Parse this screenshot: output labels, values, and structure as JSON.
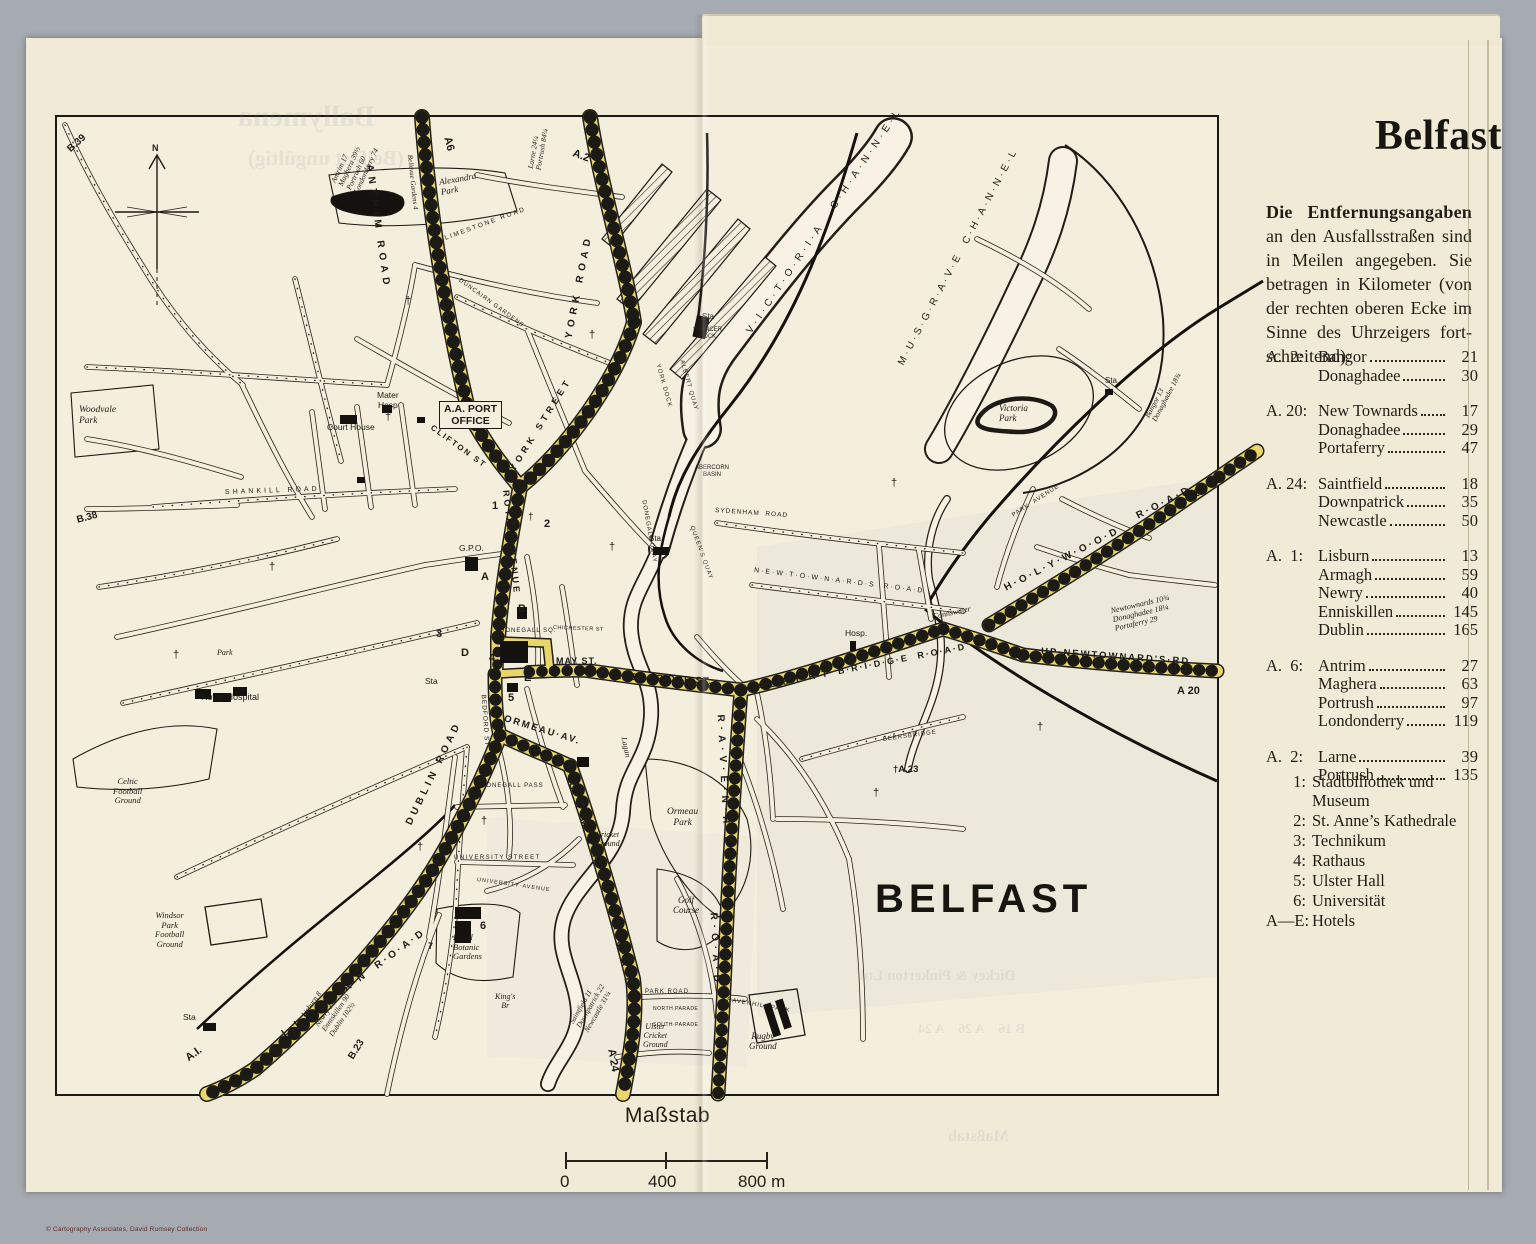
{
  "colors": {
    "paper": "#f1ead6",
    "map_paper": "#f4eedd",
    "road_yellow": "#e9d66b",
    "ink": "#1c1a15",
    "background_grey": "#a6aab1"
  },
  "page": {
    "copyright": "© Cartography Associates, David Rumsey Collection"
  },
  "panel": {
    "title": "Belfast",
    "intro_bold": "Die Entfernungsangaben",
    "intro_rest": " an den Ausfallsstraßen sind in Meilen angegeben.  Sie betragen in Kilometer (von der rechten oberen Ecke im Sinne des Uhrzeigers fort­schreitend):",
    "groups": [
      {
        "route": "A.  2:",
        "rows": [
          [
            "Bangor",
            "21"
          ],
          [
            "Donaghadee",
            "30"
          ]
        ]
      },
      {
        "route": "A. 20:",
        "rows": [
          [
            "New Townards",
            "17"
          ],
          [
            "Donaghadee",
            "29"
          ],
          [
            "Portaferry",
            "47"
          ]
        ]
      },
      {
        "route": "A. 24:",
        "rows": [
          [
            "Saintfield",
            "18"
          ],
          [
            "Downpatrick",
            "35"
          ],
          [
            "Newcastle",
            "50"
          ]
        ]
      },
      {
        "route": "A.  1:",
        "rows": [
          [
            "Lisburn",
            "13"
          ],
          [
            "Armagh",
            "59"
          ],
          [
            "Newry",
            "40"
          ],
          [
            "Enniskillen",
            "145"
          ],
          [
            "Dublin",
            "165"
          ]
        ]
      },
      {
        "route": "A.  6:",
        "rows": [
          [
            "Antrim",
            "27"
          ],
          [
            "Maghera",
            "63"
          ],
          [
            "Portrush",
            "97"
          ],
          [
            "Londonderry",
            "119"
          ]
        ]
      },
      {
        "route": "A.  2:",
        "rows": [
          [
            "Larne",
            "39"
          ],
          [
            "Portrush",
            "135"
          ]
        ]
      }
    ],
    "legend": [
      [
        "1:",
        "Stadtbiliothek und Museum"
      ],
      [
        "2:",
        "St. Anne’s Kathedrale"
      ],
      [
        "3:",
        "Technikum"
      ],
      [
        "4:",
        "Rathaus"
      ],
      [
        "5:",
        "Ulster Hall"
      ],
      [
        "6:",
        "Universität"
      ],
      [
        "A—E:",
        "Hotels"
      ]
    ]
  },
  "scale": {
    "title": "Maßstab",
    "t0": "0",
    "t400": "400",
    "t800": "800 m"
  },
  "map": {
    "city_label": "BELFAST",
    "labels": [
      {
        "t": "A6",
        "x": 390,
        "y": 14,
        "r": 75,
        "s": 11,
        "w": 700
      },
      {
        "t": "ANTRIM ROAD",
        "x": 312,
        "y": 42,
        "r": 82,
        "s": 10,
        "ls": 5,
        "w": 700
      },
      {
        "t": "Bellevue Gardens 4",
        "x": 352,
        "y": 34,
        "r": 84,
        "s": 7,
        "i": 1,
        "c": "ser"
      },
      {
        "t": "Antrim 17\nMaghera 39½\nPortrush 60\nLondonderry 74",
        "x": 288,
        "y": 54,
        "r": -65,
        "s": 7.5,
        "i": 1,
        "c": "ser"
      },
      {
        "t": "A.2",
        "x": 516,
        "y": 30,
        "r": 20,
        "s": 11,
        "w": 700
      },
      {
        "t": "Larne 24¼\nPortrush 84¼",
        "x": 478,
        "y": 44,
        "r": -80,
        "s": 7.5,
        "i": 1,
        "c": "ser"
      },
      {
        "t": "YORK ROAD",
        "x": 512,
        "y": 216,
        "r": -79,
        "s": 10,
        "ls": 5,
        "w": 700
      },
      {
        "t": "Alexandra\nPark",
        "x": 383,
        "y": 60,
        "r": -10,
        "s": 9,
        "i": 1,
        "c": "ser"
      },
      {
        "t": "LIMESTONE ROAD",
        "x": 388,
        "y": 118,
        "r": -20,
        "s": 6.5,
        "ls": 2
      },
      {
        "t": "DUNCAIRN GARDENS",
        "x": 402,
        "y": 160,
        "r": 36,
        "s": 6,
        "ls": 1
      },
      {
        "t": "B.39",
        "x": 12,
        "y": 28,
        "r": -42,
        "s": 10,
        "w": 700
      },
      {
        "t": "N",
        "x": 95,
        "y": 26,
        "s": 9,
        "w": 700
      },
      {
        "t": "Woodvale\nPark",
        "x": 22,
        "y": 288,
        "s": 9.5,
        "i": 1,
        "c": "ser"
      },
      {
        "t": "B.38",
        "x": 20,
        "y": 398,
        "r": -15,
        "s": 10,
        "w": 700
      },
      {
        "t": "SHANKILL ROAD",
        "x": 168,
        "y": 372,
        "r": -2,
        "s": 7,
        "ls": 3
      },
      {
        "t": "Mater\nHosp",
        "x": 320,
        "y": 274,
        "s": 8.5,
        "a": "center"
      },
      {
        "t": "A.A. PORT\nOFFICE",
        "x": 382,
        "y": 284,
        "s": 10.5,
        "w": 700,
        "c": "boxed",
        "a": "center"
      },
      {
        "t": "Court House",
        "x": 270,
        "y": 306,
        "s": 8.5
      },
      {
        "t": "CLIFTON ST",
        "x": 374,
        "y": 306,
        "r": 36,
        "s": 8,
        "ls": 2,
        "w": 700
      },
      {
        "t": "YORK STREET",
        "x": 455,
        "y": 348,
        "r": -58,
        "s": 9,
        "ls": 4,
        "w": 700
      },
      {
        "t": "ROYAL AVENUE",
        "x": 449,
        "y": 368,
        "r": 84,
        "s": 9,
        "ls": 3,
        "w": 700
      },
      {
        "t": "1",
        "x": 435,
        "y": 383,
        "s": 11,
        "w": 700
      },
      {
        "t": "†",
        "x": 471,
        "y": 395,
        "s": 10
      },
      {
        "t": "2",
        "x": 487,
        "y": 401,
        "s": 11,
        "w": 700
      },
      {
        "t": "G.P.O.",
        "x": 402,
        "y": 427,
        "s": 8.5
      },
      {
        "t": "A",
        "x": 424,
        "y": 454,
        "s": 11,
        "w": 700
      },
      {
        "t": "B",
        "x": 461,
        "y": 486,
        "s": 11,
        "w": 700
      },
      {
        "t": "3",
        "x": 379,
        "y": 511,
        "s": 11,
        "w": 700
      },
      {
        "t": "D",
        "x": 404,
        "y": 530,
        "s": 11,
        "w": 700
      },
      {
        "t": "4",
        "x": 432,
        "y": 535,
        "s": 11,
        "w": 700
      },
      {
        "t": "E",
        "x": 467,
        "y": 555,
        "s": 11,
        "w": 700
      },
      {
        "t": "5",
        "x": 451,
        "y": 575,
        "s": 11,
        "w": 700
      },
      {
        "t": "Sta",
        "x": 368,
        "y": 560,
        "s": 8.5
      },
      {
        "t": "DONEGALL SQ.",
        "x": 443,
        "y": 511,
        "s": 6,
        "ls": 1
      },
      {
        "t": "MAY ST.",
        "x": 499,
        "y": 539,
        "s": 9,
        "w": 700,
        "ls": 1
      },
      {
        "t": "EAST·BRIDGE·ST.",
        "x": 558,
        "y": 555,
        "r": 3,
        "s": 9.5,
        "w": 700,
        "ls": 1
      },
      {
        "t": "BEDFORD ST",
        "x": 426,
        "y": 574,
        "r": 86,
        "s": 6.5,
        "ls": 1
      },
      {
        "t": "DUBLIN ROAD",
        "x": 352,
        "y": 702,
        "r": -64,
        "s": 10,
        "ls": 4,
        "w": 700
      },
      {
        "t": "ORMEAU·AV.",
        "x": 447,
        "y": 597,
        "r": 17,
        "s": 9.5,
        "ls": 2,
        "w": 700
      },
      {
        "t": "O·R·M·E·A·U",
        "x": 514,
        "y": 660,
        "r": 72,
        "s": 10,
        "ls": 4,
        "w": 700
      },
      {
        "t": "R·O·A·D",
        "x": 558,
        "y": 800,
        "r": 78,
        "s": 10,
        "ls": 4,
        "w": 700
      },
      {
        "t": "A 24",
        "x": 554,
        "y": 926,
        "r": 80,
        "s": 11,
        "w": 700
      },
      {
        "t": "DONEGALL PASS",
        "x": 424,
        "y": 666,
        "s": 6,
        "ls": 1
      },
      {
        "t": "UNIVERSITY STREET",
        "x": 397,
        "y": 738,
        "s": 6,
        "ls": 1.5
      },
      {
        "t": "UNIVERSITY·AVENUE",
        "x": 420,
        "y": 760,
        "r": 8,
        "s": 5.5,
        "ls": 1
      },
      {
        "t": "6",
        "x": 423,
        "y": 803,
        "s": 11,
        "w": 700
      },
      {
        "t": "7",
        "x": 371,
        "y": 824,
        "s": 9,
        "w": 700
      },
      {
        "t": "Royal\nBotanic\nGardens",
        "x": 396,
        "y": 816,
        "s": 8.5,
        "i": 1,
        "c": "ser"
      },
      {
        "t": "King's\nBr",
        "x": 438,
        "y": 876,
        "s": 8,
        "i": 1,
        "a": "center",
        "c": "ser"
      },
      {
        "t": "Lagan",
        "x": 566,
        "y": 616,
        "r": 78,
        "s": 8,
        "i": 1,
        "c": "ser"
      },
      {
        "t": "Cricket\nGround",
        "x": 538,
        "y": 714,
        "s": 8,
        "i": 1,
        "a": "center",
        "c": "ser"
      },
      {
        "t": "Ormeau\nPark",
        "x": 610,
        "y": 690,
        "s": 9.5,
        "i": 1,
        "a": "center",
        "c": "ser"
      },
      {
        "t": "Golf\nCourse",
        "x": 616,
        "y": 778,
        "s": 9,
        "i": 1,
        "a": "center",
        "c": "ser"
      },
      {
        "t": "L·I·S·B·U·R·N  R·O·A·D",
        "x": 226,
        "y": 912,
        "r": -36,
        "s": 10,
        "ls": 3,
        "w": 700
      },
      {
        "t": "A.I.",
        "x": 130,
        "y": 936,
        "r": -36,
        "s": 11,
        "w": 700
      },
      {
        "t": "Lisburn 8\nArmagh 37\nNewry 37½\nEnniskillen 90\nDublin 102½",
        "x": 260,
        "y": 888,
        "r": -55,
        "s": 7.5,
        "i": 1,
        "c": "ser"
      },
      {
        "t": "B.23",
        "x": 294,
        "y": 936,
        "r": -58,
        "s": 10,
        "w": 700
      },
      {
        "t": "Windsor\nPark\nFootball\nGround",
        "x": 98,
        "y": 794,
        "s": 8.5,
        "i": 1,
        "a": "center",
        "c": "ser"
      },
      {
        "t": "Sta",
        "x": 126,
        "y": 896,
        "s": 8.5
      },
      {
        "t": "Celtic\nFootball\nGround",
        "x": 56,
        "y": 660,
        "s": 8.5,
        "i": 1,
        "a": "center",
        "c": "ser"
      },
      {
        "t": "Royal Hospital",
        "x": 144,
        "y": 575,
        "s": 9
      },
      {
        "t": "Park",
        "x": 160,
        "y": 532,
        "s": 8,
        "i": 1,
        "c": "ser"
      },
      {
        "t": "Saintfield 11\nDownpatrick 22\nNewcastle 31¼",
        "x": 522,
        "y": 898,
        "r": -60,
        "s": 7.5,
        "i": 1,
        "c": "ser"
      },
      {
        "t": "R·A·V·E·N·H·I·L·L",
        "x": 663,
        "y": 592,
        "r": 87,
        "s": 10,
        "ls": 5,
        "w": 700
      },
      {
        "t": "R·O·A·D",
        "x": 656,
        "y": 790,
        "r": 87,
        "s": 10,
        "ls": 5,
        "w": 700
      },
      {
        "t": "RAVENHILL PARK",
        "x": 670,
        "y": 880,
        "r": 10,
        "s": 6,
        "ls": 1
      },
      {
        "t": "PARK ROAD",
        "x": 588,
        "y": 872,
        "s": 6,
        "ls": 1
      },
      {
        "t": "NORTH PARADE",
        "x": 596,
        "y": 890,
        "s": 5,
        "ls": 0.5
      },
      {
        "t": "SOUTH·PARADE",
        "x": 596,
        "y": 906,
        "s": 5,
        "ls": 0.5
      },
      {
        "t": "Ulster\nCricket\nGround",
        "x": 586,
        "y": 906,
        "s": 8,
        "i": 1,
        "a": "center",
        "c": "ser"
      },
      {
        "t": "Rugby\nGround",
        "x": 692,
        "y": 914,
        "s": 9,
        "i": 1,
        "a": "center",
        "c": "ser"
      },
      {
        "t": "†A.23",
        "x": 836,
        "y": 648,
        "s": 9.5,
        "w": 700
      },
      {
        "t": "Hosp.",
        "x": 788,
        "y": 512,
        "s": 8.5
      },
      {
        "t": "A·L·B·E·R·T  B·R·I·D·G·E  R·O·A·D",
        "x": 700,
        "y": 565,
        "r": -11,
        "s": 9,
        "ls": 2,
        "w": 700
      },
      {
        "t": "N·E·W·T·O·W·N·A·R·D·S  R·O·A·D",
        "x": 697,
        "y": 450,
        "r": 7,
        "s": 7,
        "ls": 2
      },
      {
        "t": "Connswater",
        "x": 876,
        "y": 496,
        "r": -12,
        "s": 8,
        "i": 1,
        "c": "ser"
      },
      {
        "t": "Cr",
        "x": 884,
        "y": 512,
        "r": -12,
        "s": 7,
        "i": 1,
        "c": "ser"
      },
      {
        "t": "BEERSBRIDGE",
        "x": 826,
        "y": 620,
        "r": -8,
        "s": 6,
        "ls": 1
      },
      {
        "t": "UP·NEWTOWNARD'S·RD",
        "x": 984,
        "y": 530,
        "r": 4,
        "s": 9.5,
        "ls": 2,
        "w": 700
      },
      {
        "t": "A 20",
        "x": 1120,
        "y": 568,
        "s": 11,
        "w": 700
      },
      {
        "t": "Newtownards 10¾\nDonaghadee 18¼\nPortaferry 29",
        "x": 1056,
        "y": 490,
        "r": -13,
        "s": 8,
        "i": 1,
        "c": "ser"
      },
      {
        "t": "H·O·L·Y·W·O·O·D",
        "x": 948,
        "y": 466,
        "r": -27,
        "s": 10,
        "ls": 3,
        "w": 700
      },
      {
        "t": "R·O·A·D",
        "x": 1080,
        "y": 394,
        "r": -27,
        "s": 10,
        "ls": 3,
        "w": 700
      },
      {
        "t": "A 2",
        "x": 1126,
        "y": 370,
        "s": 11,
        "w": 700
      },
      {
        "t": "Bangor 13\nDonaghadee 18¾",
        "x": 1094,
        "y": 294,
        "r": -62,
        "s": 7.5,
        "i": 1,
        "c": "ser"
      },
      {
        "t": "PARK  AVENUE",
        "x": 956,
        "y": 396,
        "r": -33,
        "s": 6,
        "ls": 1
      },
      {
        "t": "Victoria\nPark",
        "x": 942,
        "y": 286,
        "s": 9,
        "i": 1,
        "c": "ser"
      },
      {
        "t": "Sta",
        "x": 1048,
        "y": 260,
        "s": 8
      },
      {
        "t": "V·I·C·T·O·R·I·A   C·H·A·N·N·E·L",
        "x": 692,
        "y": 210,
        "r": -56,
        "s": 10,
        "ls": 4
      },
      {
        "t": "M·U·S·G·R·A·V·E  C·H·A·N·N·E·L",
        "x": 844,
        "y": 242,
        "r": -62,
        "s": 10,
        "ls": 3
      },
      {
        "t": "SPENCER\nDOCK",
        "x": 636,
        "y": 210,
        "s": 6,
        "a": "center"
      },
      {
        "t": "YORK DOCK",
        "x": 600,
        "y": 244,
        "r": 74,
        "s": 6,
        "ls": 1
      },
      {
        "t": "ALBERT QUAY",
        "x": 624,
        "y": 240,
        "r": 74,
        "s": 6,
        "ls": 1
      },
      {
        "t": "DONEGALL QUAY",
        "x": 586,
        "y": 380,
        "r": 80,
        "s": 6,
        "ls": 1
      },
      {
        "t": "QUEEN'S QUAY",
        "x": 634,
        "y": 406,
        "r": 70,
        "s": 6,
        "ls": 1
      },
      {
        "t": "ABERCORN\nBASIN",
        "x": 638,
        "y": 348,
        "s": 6,
        "a": "center"
      },
      {
        "t": "SYDENHAM  ROAD",
        "x": 658,
        "y": 390,
        "r": 4,
        "s": 6.5,
        "ls": 1
      },
      {
        "t": "Sta",
        "x": 592,
        "y": 418,
        "s": 8
      },
      {
        "t": "Sta",
        "x": 645,
        "y": 196,
        "s": 8
      },
      {
        "t": "CHICHESTER ST",
        "x": 496,
        "y": 508,
        "r": 2,
        "s": 5.5,
        "ls": 0.5
      },
      {
        "t": "†",
        "x": 212,
        "y": 444,
        "s": 11
      },
      {
        "t": "†",
        "x": 328,
        "y": 294,
        "s": 11
      },
      {
        "t": "†",
        "x": 116,
        "y": 532,
        "s": 11
      },
      {
        "t": "†",
        "x": 552,
        "y": 424,
        "s": 11
      },
      {
        "t": "†",
        "x": 424,
        "y": 698,
        "s": 11
      },
      {
        "t": "†",
        "x": 360,
        "y": 724,
        "s": 11
      },
      {
        "t": "†",
        "x": 532,
        "y": 212,
        "s": 11
      },
      {
        "t": "†",
        "x": 834,
        "y": 360,
        "s": 11
      },
      {
        "t": "†",
        "x": 980,
        "y": 604,
        "s": 11
      },
      {
        "t": "†",
        "x": 348,
        "y": 178,
        "s": 11
      },
      {
        "t": "†",
        "x": 570,
        "y": 886,
        "s": 11
      },
      {
        "t": "†",
        "x": 816,
        "y": 670,
        "s": 11
      }
    ]
  },
  "bleedthrough": [
    {
      "t": "Ballymena",
      "x": 238,
      "y": 100,
      "s": 30
    },
    {
      "t": "(Belfast ungültig)",
      "x": 248,
      "y": 146,
      "s": 21
    },
    {
      "t": "Dickey & Pinkerton Ltd",
      "x": 860,
      "y": 968,
      "s": 15
    },
    {
      "t": "B 16    A 26    A 24",
      "x": 918,
      "y": 1022,
      "s": 14
    },
    {
      "t": "Maßstab",
      "x": 948,
      "y": 1128,
      "s": 16
    }
  ]
}
